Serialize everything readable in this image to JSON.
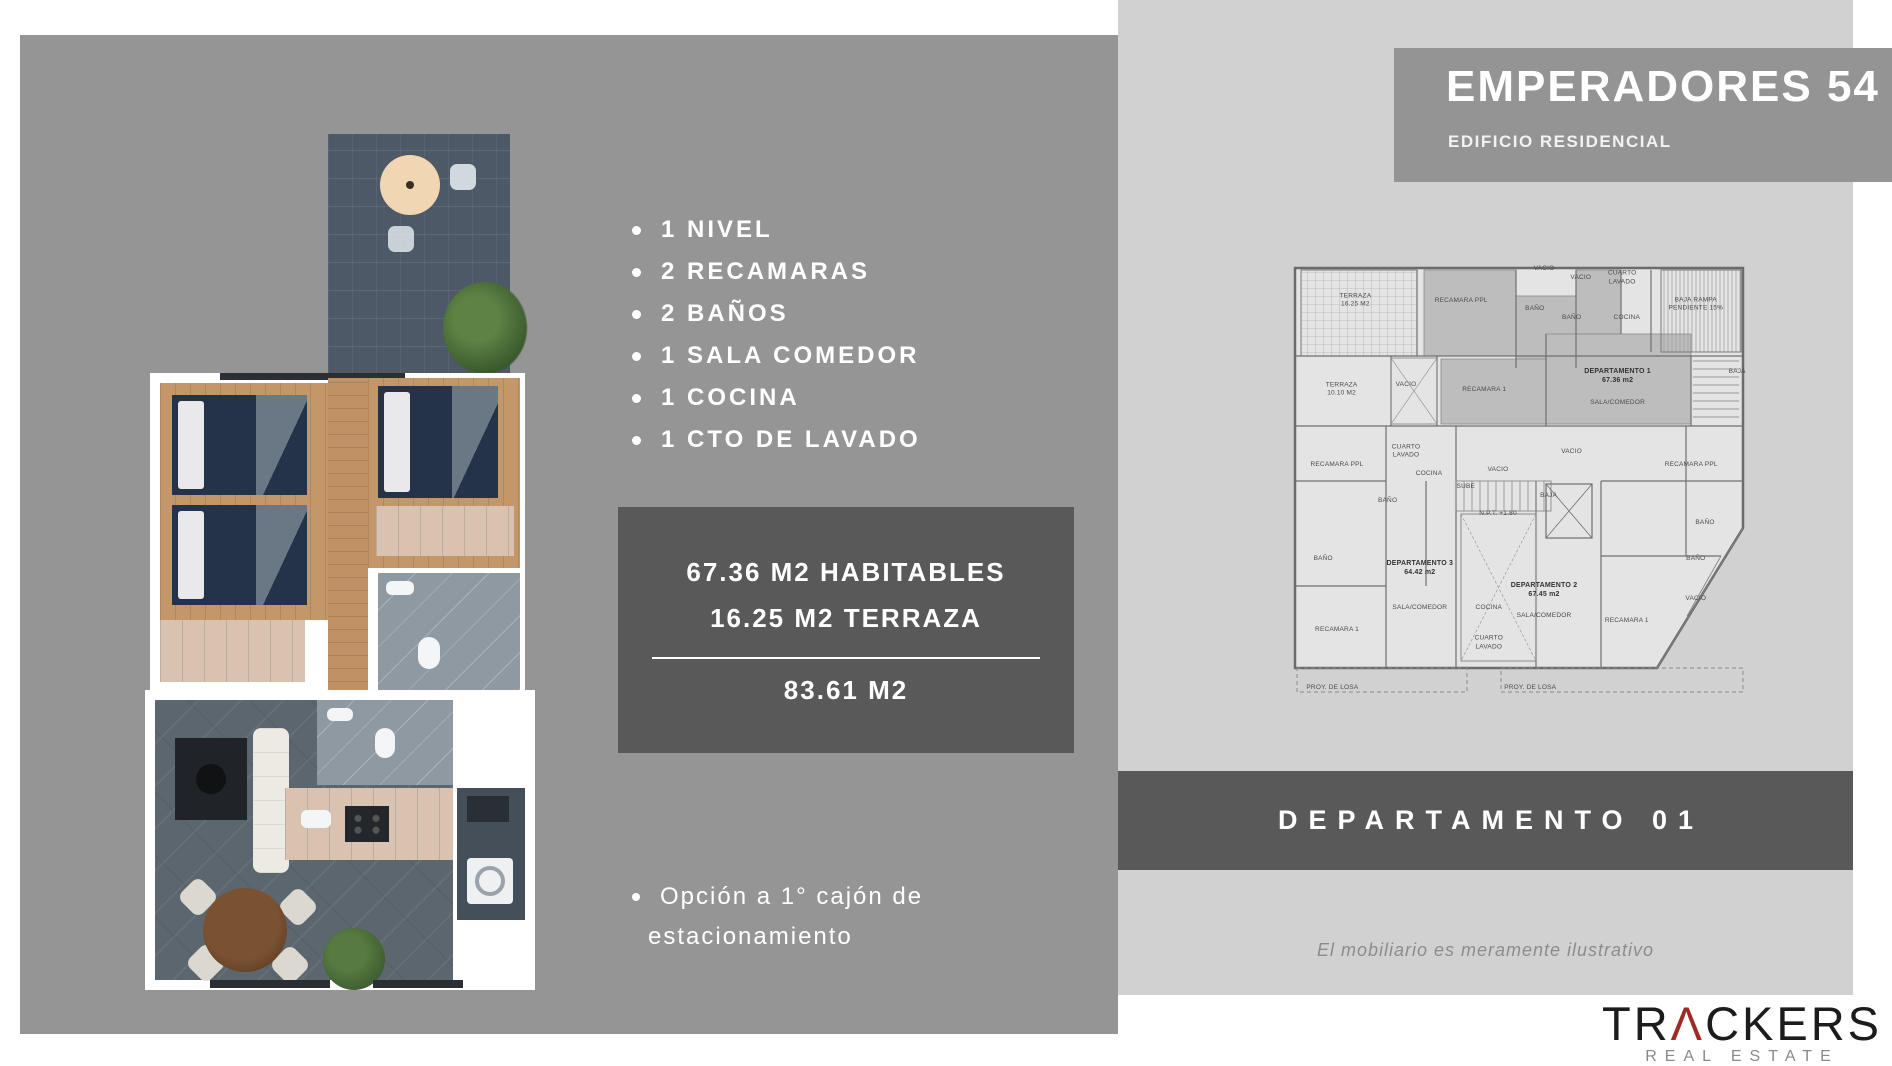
{
  "colors": {
    "panel_gray": "#959595",
    "light_gray": "#d1d1d1",
    "dark_gray": "#595959",
    "logo_accent": "#9e2b25"
  },
  "left_panel": {
    "features": {
      "items": [
        "1 NIVEL",
        "2 RECAMARAS",
        "2 BAÑOS",
        "1 SALA COMEDOR",
        "1 COCINA",
        "1 CTO DE LAVADO"
      ]
    },
    "area_box": {
      "line1": "67.36 M2 HABITABLES",
      "line2": "16.25 M2 TERRAZA",
      "total": "83.61 M2"
    },
    "parking_note": {
      "line1": "Opción a 1° cajón de",
      "line2": "estacionamiento"
    }
  },
  "right_panel": {
    "header": {
      "title": "EMPERADORES 54",
      "subtitle": "EDIFICIO RESIDENCIAL"
    },
    "banner": {
      "label": "DEPARTAMENTO 01"
    },
    "disclaimer": "El mobiliario es meramente ilustrativo",
    "floorplan": {
      "labels": [
        {
          "t": "TERRAZA\n16.25 M2",
          "x": 14,
          "y": 10
        },
        {
          "t": "RECAMARA PPL",
          "x": 37,
          "y": 10
        },
        {
          "t": "VACIO",
          "x": 55,
          "y": 3
        },
        {
          "t": "VACIO",
          "x": 63,
          "y": 5
        },
        {
          "t": "CUARTO\nLAVADO",
          "x": 72,
          "y": 5
        },
        {
          "t": "BAÑO",
          "x": 53,
          "y": 12
        },
        {
          "t": "BAÑO",
          "x": 61,
          "y": 14
        },
        {
          "t": "COCINA",
          "x": 73,
          "y": 14
        },
        {
          "t": "BAJA RAMPA\nPENDIENTE 15%",
          "x": 88,
          "y": 11
        },
        {
          "t": "TERRAZA\n10.10 M2",
          "x": 11,
          "y": 30
        },
        {
          "t": "VACIO",
          "x": 25,
          "y": 29
        },
        {
          "t": "RECAMARA 1",
          "x": 42,
          "y": 30
        },
        {
          "t": "DEPARTAMENTO 1\n67.36 m2",
          "x": 71,
          "y": 27,
          "strong": true
        },
        {
          "t": "SALA/COMEDOR",
          "x": 71,
          "y": 33
        },
        {
          "t": "BAJA",
          "x": 97,
          "y": 26
        },
        {
          "t": "RECAMARA PPL",
          "x": 10,
          "y": 47
        },
        {
          "t": "BAÑO",
          "x": 21,
          "y": 55
        },
        {
          "t": "BAÑO",
          "x": 7,
          "y": 68
        },
        {
          "t": "CUARTO\nLAVADO",
          "x": 25,
          "y": 44
        },
        {
          "t": "COCINA",
          "x": 30,
          "y": 49
        },
        {
          "t": "VACIO",
          "x": 45,
          "y": 48
        },
        {
          "t": "VACIO",
          "x": 61,
          "y": 44
        },
        {
          "t": "SUBE",
          "x": 38,
          "y": 52
        },
        {
          "t": "N.P.T. +1.80",
          "x": 45,
          "y": 58
        },
        {
          "t": "BAJA",
          "x": 56,
          "y": 54
        },
        {
          "t": "DEPARTAMENTO 3\n64.42 m2",
          "x": 28,
          "y": 70,
          "strong": true
        },
        {
          "t": "SALA/COMEDOR",
          "x": 28,
          "y": 79
        },
        {
          "t": "RECAMARA 1",
          "x": 10,
          "y": 84
        },
        {
          "t": "COCINA",
          "x": 43,
          "y": 79
        },
        {
          "t": "CUARTO\nLAVADO",
          "x": 43,
          "y": 87
        },
        {
          "t": "DEPARTAMENTO 2\n67.45 m2",
          "x": 55,
          "y": 75,
          "strong": true
        },
        {
          "t": "SALA/COMEDOR",
          "x": 55,
          "y": 81
        },
        {
          "t": "RECAMARA 1",
          "x": 73,
          "y": 82
        },
        {
          "t": "RECAMARA PPL",
          "x": 87,
          "y": 47
        },
        {
          "t": "BAÑO",
          "x": 90,
          "y": 60
        },
        {
          "t": "BAÑO",
          "x": 88,
          "y": 68
        },
        {
          "t": "VACIO",
          "x": 88,
          "y": 77
        },
        {
          "t": "PROY. DE LOSA",
          "x": 9,
          "y": 97
        },
        {
          "t": "PROY. DE LOSA",
          "x": 52,
          "y": 97
        }
      ]
    }
  },
  "logo": {
    "part1": "TR",
    "accent": "Λ",
    "part2": "CKERS",
    "tagline": "REAL ESTATE"
  }
}
